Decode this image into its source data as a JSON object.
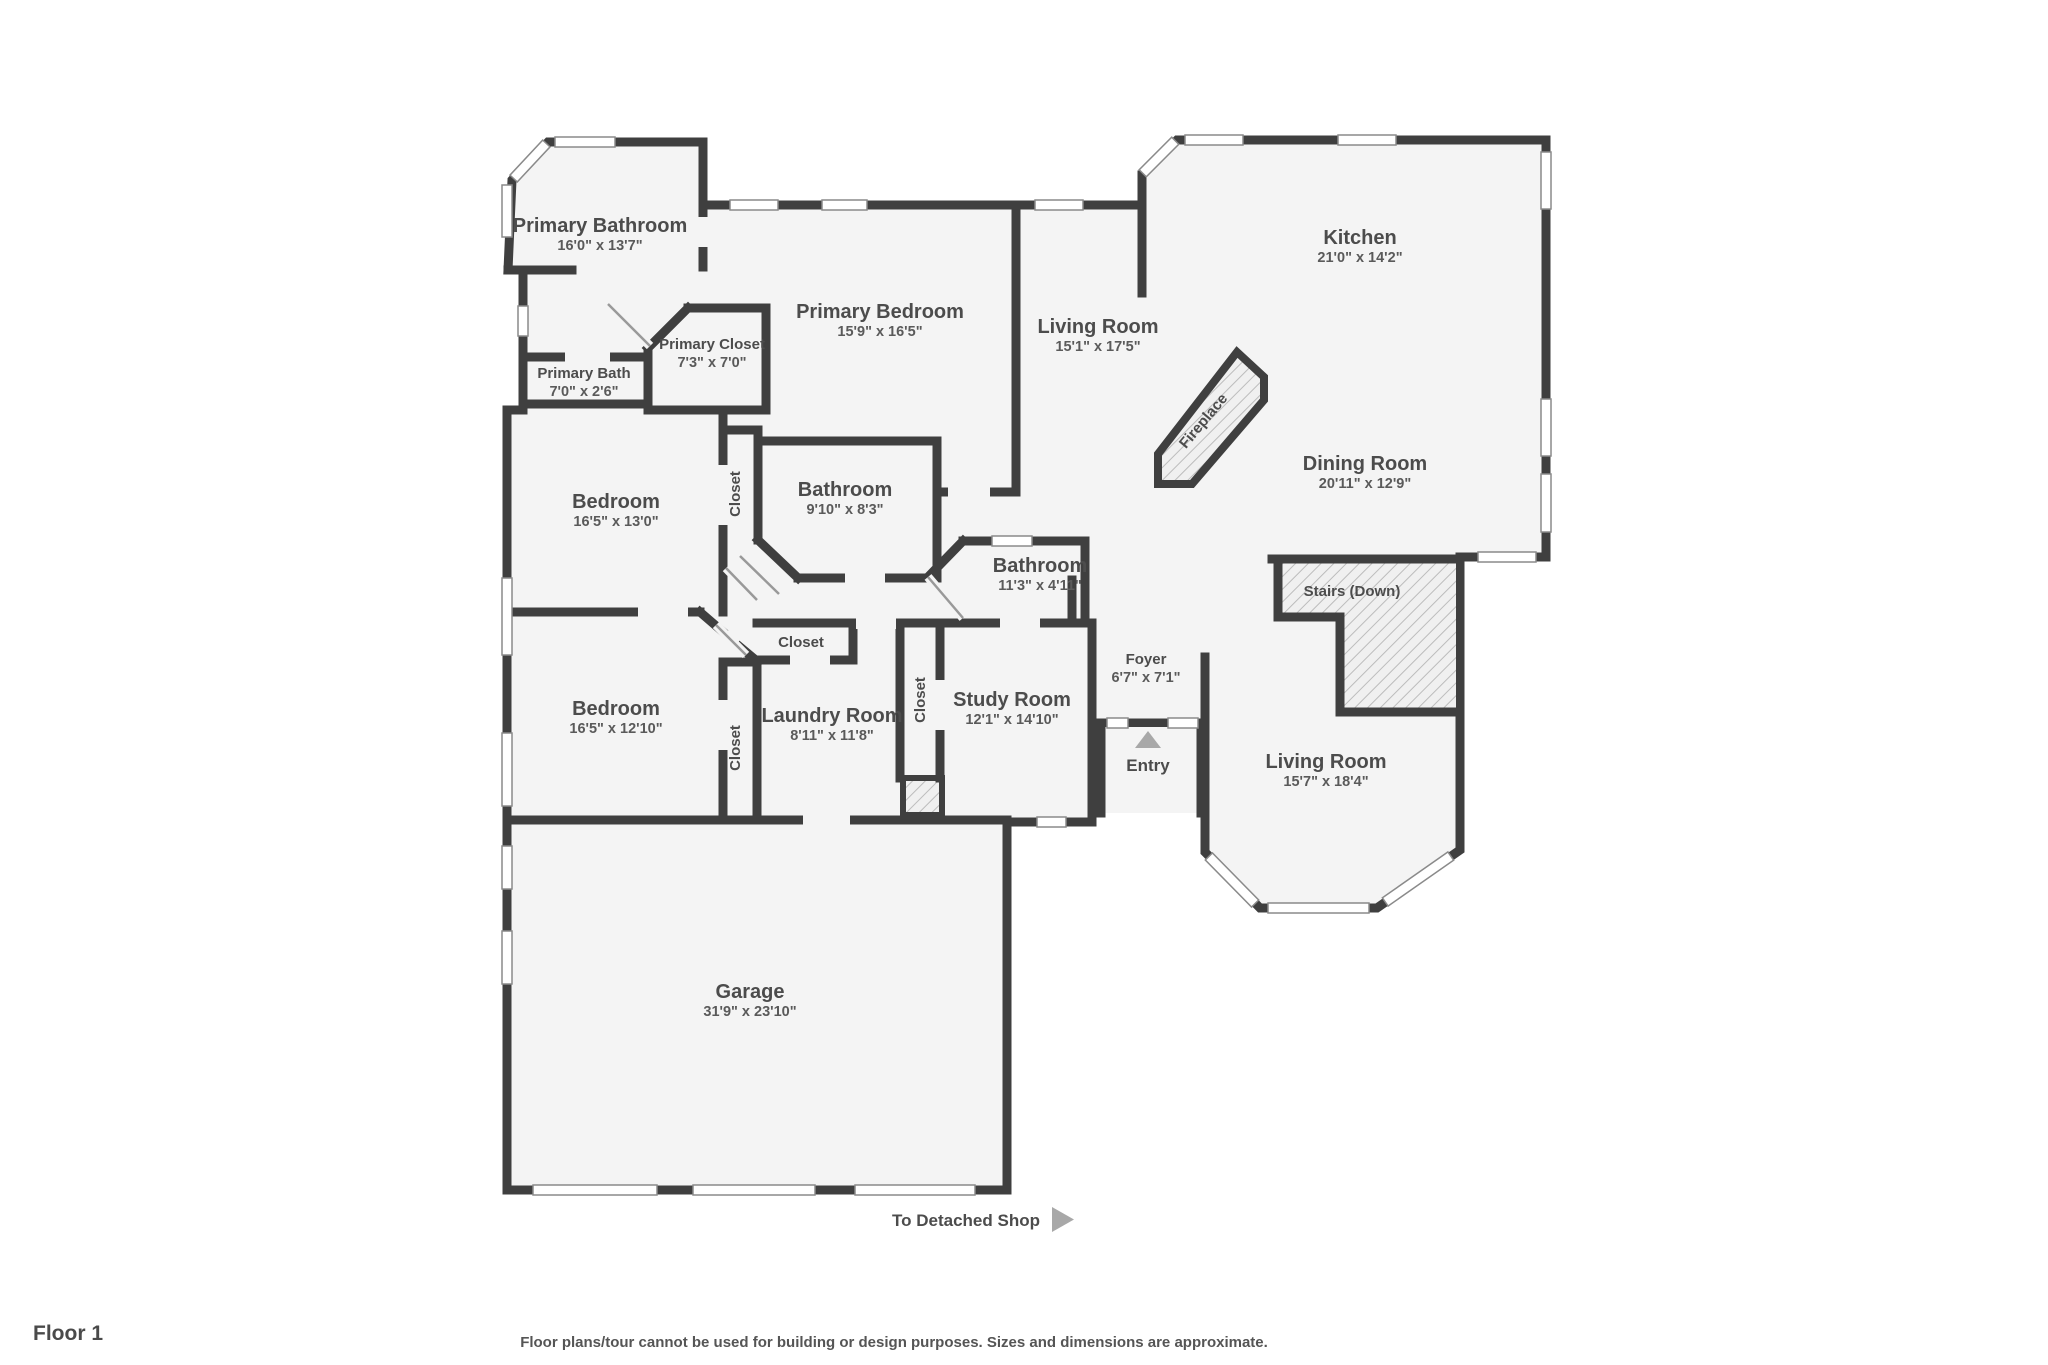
{
  "floor_label": "Floor 1",
  "disclaimer": "Floor plans/tour cannot be used for building or design purposes. Sizes and dimensions are approximate.",
  "shop_link": {
    "text": "To Detached Shop",
    "arrow_icon": "right-triangle"
  },
  "entry": {
    "label": "Entry",
    "marker_icon": "up-triangle"
  },
  "fireplace_label": "Fireplace",
  "stairs_label": "Stairs (Down)",
  "colors": {
    "wall": "#3f3f3f",
    "room_fill": "#f4f4f4",
    "label_text": "#4c4c4c",
    "dims_text": "#5a5a5a",
    "marker": "#a8a8a8",
    "hatch_line": "#bcbcbc"
  },
  "rooms": [
    {
      "name": "Primary Bathroom",
      "dims": "16'0\" x 13'7\"",
      "x": 600,
      "y": 232
    },
    {
      "name": "Primary Closet",
      "dims": "7'3\" x 7'0\"",
      "x": 712,
      "y": 349,
      "small": true
    },
    {
      "name": "Primary Bath",
      "dims": "7'0\" x 2'6\"",
      "x": 584,
      "y": 378,
      "small": true
    },
    {
      "name": "Primary Bedroom",
      "dims": "15'9\" x 16'5\"",
      "x": 880,
      "y": 318
    },
    {
      "name": "Living Room",
      "dims": "15'1\" x 17'5\"",
      "x": 1098,
      "y": 333
    },
    {
      "name": "Kitchen",
      "dims": "21'0\" x 14'2\"",
      "x": 1360,
      "y": 244
    },
    {
      "name": "Dining Room",
      "dims": "20'11\" x 12'9\"",
      "x": 1365,
      "y": 470
    },
    {
      "name": "Bedroom",
      "dims": "16'5\" x 13'0\"",
      "x": 616,
      "y": 508
    },
    {
      "name": "Bathroom",
      "dims": "9'10\" x 8'3\"",
      "x": 845,
      "y": 496
    },
    {
      "name": "Bathroom",
      "dims": "11'3\" x 4'11\"",
      "x": 1040,
      "y": 572
    },
    {
      "name": "Bedroom",
      "dims": "16'5\" x 12'10\"",
      "x": 616,
      "y": 715
    },
    {
      "name": "Laundry Room",
      "dims": "8'11\" x 11'8\"",
      "x": 832,
      "y": 722
    },
    {
      "name": "Study Room",
      "dims": "12'1\" x 14'10\"",
      "x": 1012,
      "y": 706
    },
    {
      "name": "Foyer",
      "dims": "6'7\" x 7'1\"",
      "x": 1146,
      "y": 664,
      "small": true
    },
    {
      "name": "Living Room",
      "dims": "15'7\" x 18'4\"",
      "x": 1326,
      "y": 768
    },
    {
      "name": "Garage",
      "dims": "31'9\" x 23'10\"",
      "x": 750,
      "y": 998
    },
    {
      "name": "Closet",
      "dims": "",
      "x": 740,
      "y": 494,
      "rot": -90,
      "small": true
    },
    {
      "name": "Closet",
      "dims": "",
      "x": 801,
      "y": 647,
      "rot": 0,
      "small": true
    },
    {
      "name": "Closet",
      "dims": "",
      "x": 925,
      "y": 700,
      "rot": -90,
      "small": true
    },
    {
      "name": "Closet",
      "dims": "",
      "x": 740,
      "y": 748,
      "rot": -90,
      "small": true
    }
  ]
}
